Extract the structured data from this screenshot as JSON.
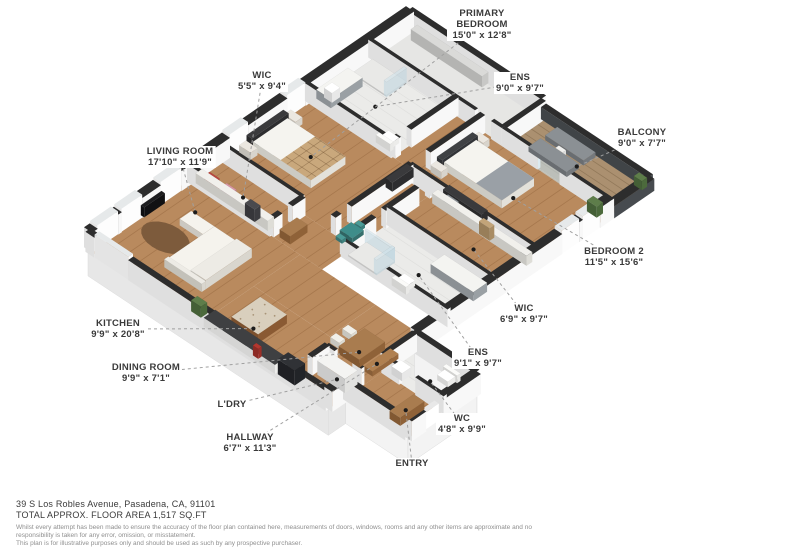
{
  "floorplan": {
    "rooms": [
      {
        "id": "living-room",
        "label": "LIVING ROOM",
        "dims": "17'10\" x 11'9\""
      },
      {
        "id": "kitchen",
        "label": "KITCHEN",
        "dims": "9'9\" x 20'8\""
      },
      {
        "id": "dining-room",
        "label": "DINING ROOM",
        "dims": "9'9\" x 7'1\""
      },
      {
        "id": "ldry",
        "label": "L'DRY",
        "dims": ""
      },
      {
        "id": "hallway",
        "label": "HALLWAY",
        "dims": "6'7\" x 11'3\""
      },
      {
        "id": "entry",
        "label": "ENTRY",
        "dims": ""
      },
      {
        "id": "wc",
        "label": "WC",
        "dims": "4'8\" x 9'9\""
      },
      {
        "id": "ens-2",
        "label": "ENS",
        "dims": "9'1\" x 9'7\""
      },
      {
        "id": "wic-2",
        "label": "WIC",
        "dims": "6'9\" x 9'7\""
      },
      {
        "id": "bedroom-2",
        "label": "BEDROOM 2",
        "dims": "11'5\" x 15'6\""
      },
      {
        "id": "balcony",
        "label": "BALCONY",
        "dims": "9'0\" x 7'7\""
      },
      {
        "id": "ens-primary",
        "label": "ENS",
        "dims": "9'0\" x 9'7\""
      },
      {
        "id": "primary-bedroom",
        "label": "PRIMARY BEDROOM",
        "dims": "15'0\" x 12'8\""
      },
      {
        "id": "wic-primary",
        "label": "WIC",
        "dims": "5'5\" x 9'4\""
      }
    ],
    "palette": {
      "wood": "#b98a5e",
      "bath_floor": "#ebebe9",
      "balcony_deck": "#ab9070",
      "storage_floor": "#e6e6e4",
      "wall_top": "#2d2d2d",
      "wall_face": "#f8f8f8",
      "parapet_face": "#474b4f",
      "label_text": "#3a3a3a",
      "leader": "#a0a0a0",
      "dot": "#1c1c1c",
      "accent_teal": "#3e8d8a"
    }
  },
  "footer": {
    "address": "39 S Los Robles Avenue, Pasadena, CA, 91101",
    "area_line": "TOTAL APPROX. FLOOR AREA 1,517 SQ.FT",
    "disclaimer_line1": "Whilst every attempt has been made to ensure the accuracy of the floor plan contained here, measurements of doors, windows, rooms and any other items are approximate and no responsibility is taken for any error, omission, or misstatement.",
    "disclaimer_line2": "This plan is for illustrative purposes only and should be used as such by any prospective purchaser."
  }
}
